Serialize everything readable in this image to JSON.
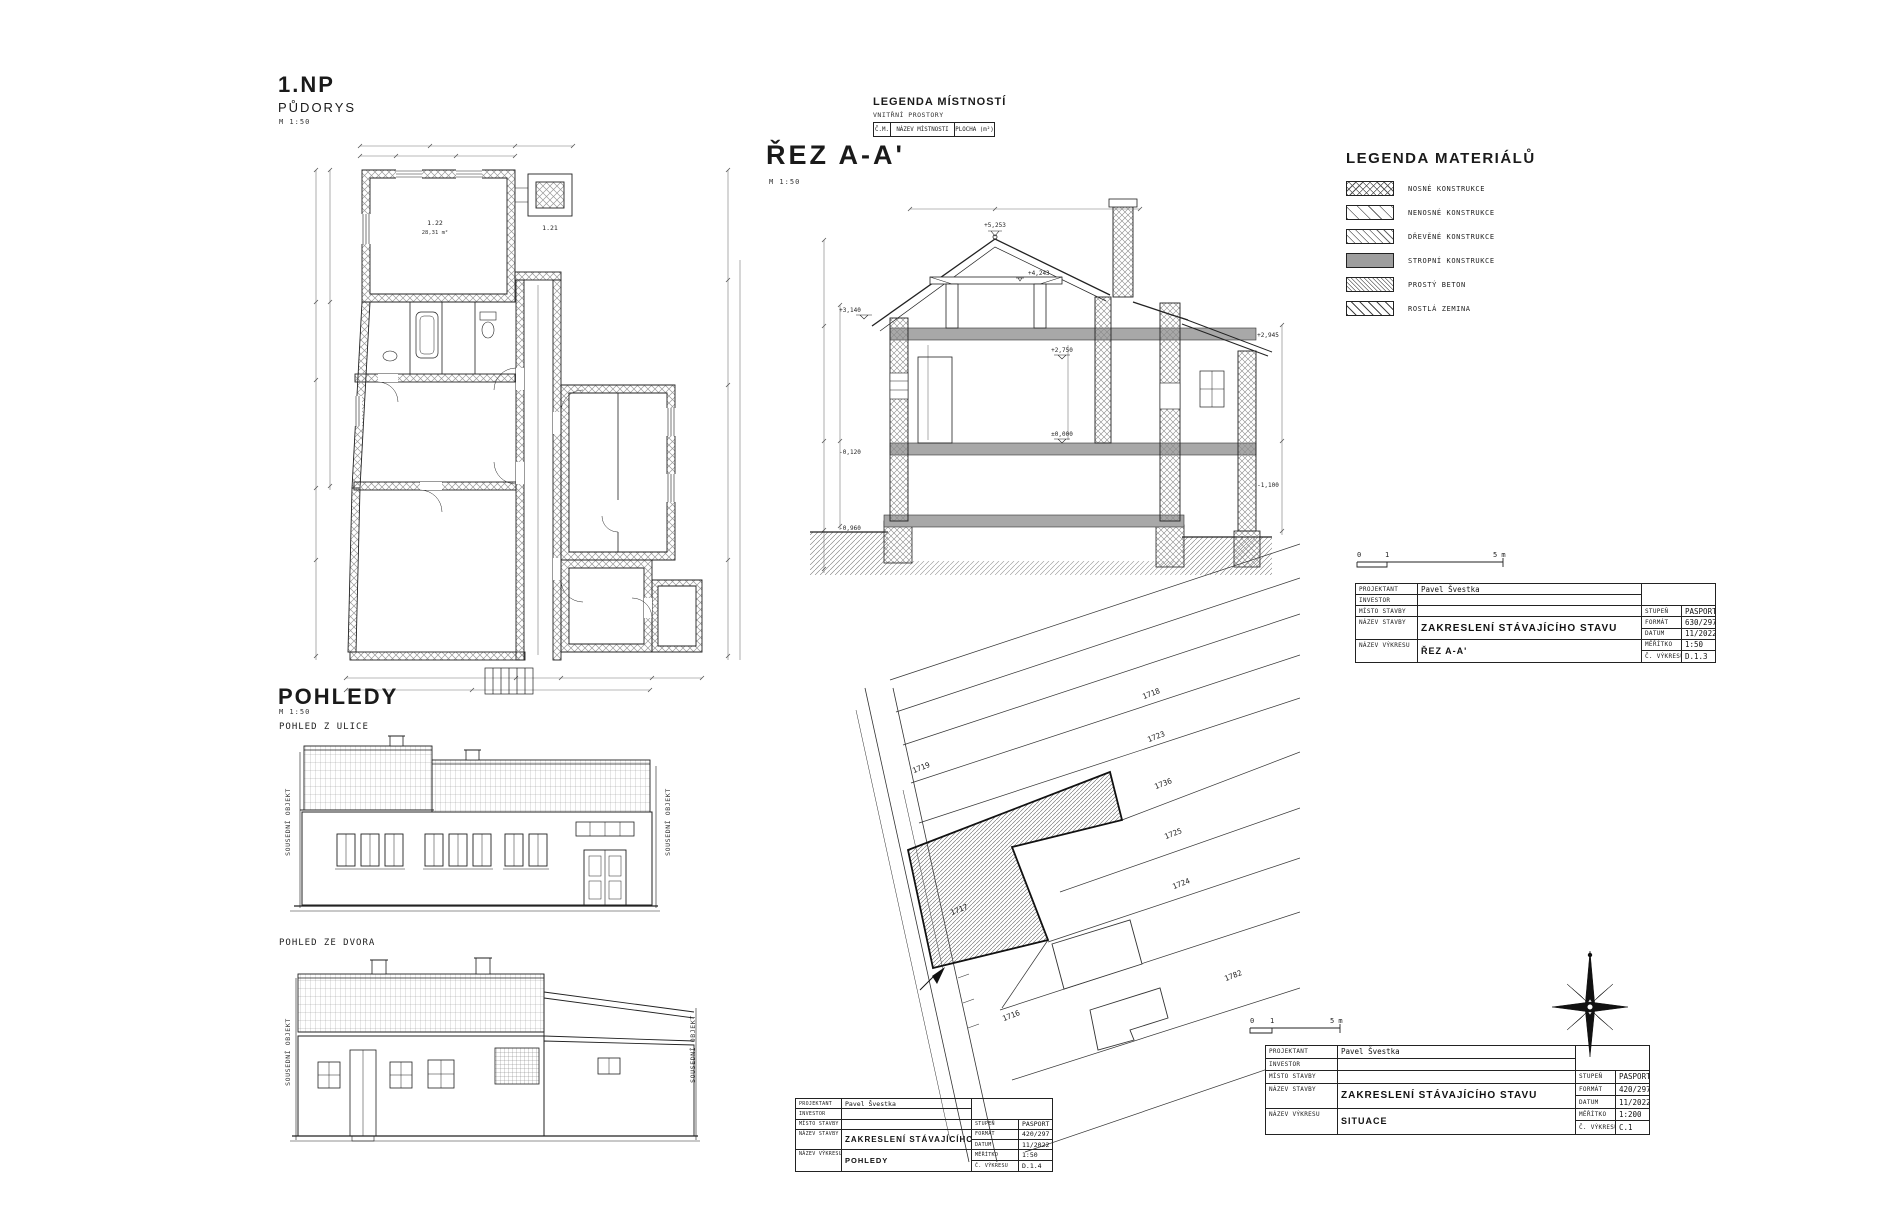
{
  "page": {
    "background": "#ffffff",
    "ink": "#222222"
  },
  "floor_plan": {
    "title": "1.NP",
    "subtitle": "PŮDORYS",
    "scale": "M 1:50",
    "room_main_id": "1.22",
    "room_main_area": "28,31 m²",
    "room_small_id": "1.21"
  },
  "section": {
    "title": "ŘEZ A-A'",
    "scale": "M 1:50",
    "levels": {
      "ridge": "+5,253",
      "collar": "+4,243",
      "ceiling": "+2,750",
      "floor": "±0,000",
      "eave": "+3,140",
      "terrain": "-0,120",
      "base": "-0,960",
      "attic": "+2,945",
      "low": "-1,100"
    }
  },
  "room_legend": {
    "title": "LEGENDA MÍSTNOSTÍ",
    "subtitle": "VNITŘNÍ PROSTORY",
    "columns": [
      "Č.M.",
      "NÁZEV MÍSTNOSTI",
      "PLOCHA (m²)"
    ]
  },
  "materials_legend": {
    "title": "LEGENDA MATERIÁLŮ",
    "items": [
      {
        "label": "NOSNÉ KONSTRUKCE"
      },
      {
        "label": "NENOSNÉ KONSTRUKCE"
      },
      {
        "label": "DŘEVĚNÉ KONSTRUKCE"
      },
      {
        "label": "STROPNÍ KONSTRUKCE"
      },
      {
        "label": "PROSTÝ BETON"
      },
      {
        "label": "ROSTLÁ ZEMINA"
      }
    ]
  },
  "scalebar": {
    "zero": "0",
    "one": "1",
    "five": "5 m"
  },
  "titleblock_labels": {
    "projektant": "PROJEKTANT",
    "investor": "INVESTOR",
    "misto_stavby": "MÍSTO STAVBY",
    "nazev_stavby": "NÁZEV STAVBY",
    "nazev_vykresu": "NÁZEV VÝKRESU",
    "stupen": "STUPEŇ",
    "format": "FORMÁT",
    "datum": "DATUM",
    "meritko": "MĚŘÍTKO",
    "cislo_vykresu": "Č. VÝKRESU"
  },
  "tb_section": {
    "projektant": "Pavel Švestka",
    "nazev_stavby": "ZAKRESLENÍ STÁVAJÍCÍHO STAVU",
    "nazev_vykresu": "ŘEZ A-A'",
    "stupen": "PASPORT",
    "format": "630/297",
    "datum": "11/2022",
    "meritko": "1:50",
    "cislo": "D.1.3"
  },
  "tb_situace": {
    "projektant": "Pavel Švestka",
    "nazev_stavby": "ZAKRESLENÍ STÁVAJÍCÍHO STAVU",
    "nazev_vykresu": "SITUACE",
    "stupen": "PASPORT",
    "format": "420/297",
    "datum": "11/2022",
    "meritko": "1:200",
    "cislo": "C.1"
  },
  "tb_pohledy": {
    "projektant": "Pavel Švestka",
    "nazev_stavby": "ZAKRESLENÍ STÁVAJÍCÍHO STAVU",
    "nazev_vykresu": "POHLEDY",
    "stupen": "PASPORT",
    "format": "420/297",
    "datum": "11/2022",
    "meritko": "1:50",
    "cislo": "D.1.4"
  },
  "elevations": {
    "title": "POHLEDY",
    "scale": "M 1:50",
    "street_label": "POHLED Z ULICE",
    "yard_label": "POHLED ZE DVORA",
    "neighbor_label": "SOUSEDNÍ OBJEKT"
  },
  "site_plan": {
    "parcels": [
      "1719",
      "1718",
      "1723",
      "1736",
      "1725",
      "1724",
      "1717",
      "1782",
      "1716"
    ]
  }
}
